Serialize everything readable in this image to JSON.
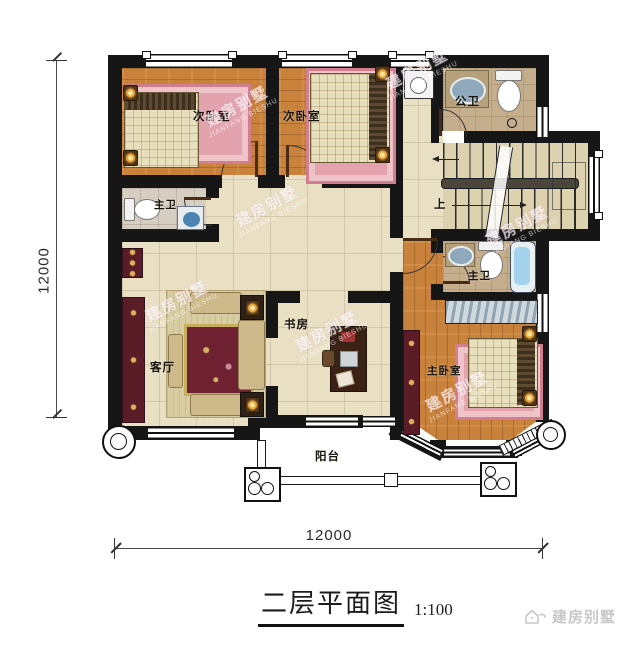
{
  "plan": {
    "rooms": {
      "bedroom_a": "次卧室",
      "bedroom_b": "次卧室",
      "public_bath": "公卫",
      "bath_left": "主卫",
      "living": "客厅",
      "study": "书房",
      "master_bedroom": "主卧室",
      "master_bath": "主卫",
      "balcony": "阳台"
    },
    "stairs_up": "上"
  },
  "dimensions": {
    "width": "12000",
    "height": "12000"
  },
  "title": {
    "name": "二层平面图",
    "scale": "1:100"
  },
  "watermark": {
    "cn": "建房别墅",
    "en": "JIANFANG BIESHU"
  },
  "logo": {
    "brand": "建房别墅"
  },
  "colors": {
    "wall": "#161616",
    "wood_floor": "#c9823c",
    "tile_floor": "#e9e0c4",
    "bath_floor": "#c4ae8b",
    "rug_pink": "#e2a3ae",
    "accent_red": "#5a1d27",
    "logo_gray": "#c8c8c8"
  }
}
